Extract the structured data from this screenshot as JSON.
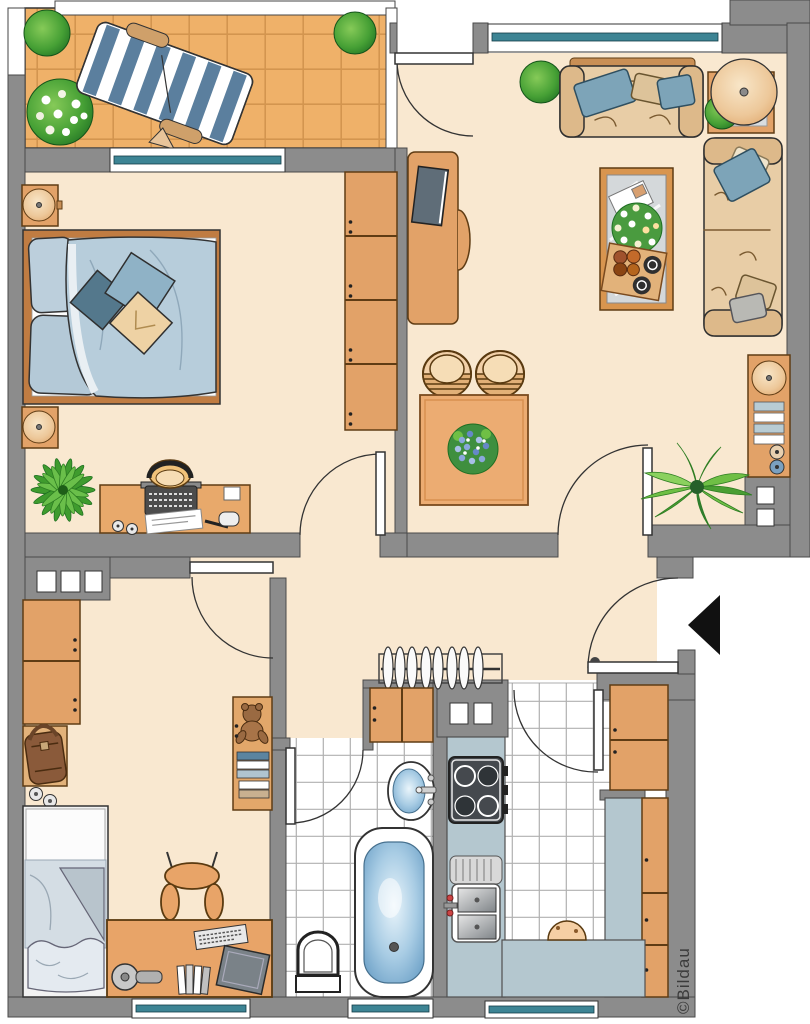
{
  "watermark": {
    "label": "©Bildau"
  },
  "colors": {
    "wall": "#8c8c8c",
    "wallLine": "#4a4a4a",
    "floor": "#f9e8d0",
    "balconyTile": "#efb169",
    "balconyGrout": "#d3954f",
    "wood": "#e2a268",
    "woodDark": "#5f3c14",
    "tableWood": "#ecac72",
    "windowTeal": "#3d8494",
    "bedBlue": "#b7cddb",
    "pillowBlue": "#7da4b8",
    "pillowTan": "#ddc39a",
    "sofa": "#e8cda6",
    "sofaDark": "#ddb98a",
    "counter": "#b4c7cf",
    "tubBlue": "#5e96c0",
    "plantGreen": "#46a035",
    "plantDark": "#1e6e22",
    "flowerBlue": "#7ea0d8",
    "loungerBlue": "#5b7f9e",
    "arrowBlack": "#111111",
    "watermarkInk": "#3b3b3b"
  }
}
